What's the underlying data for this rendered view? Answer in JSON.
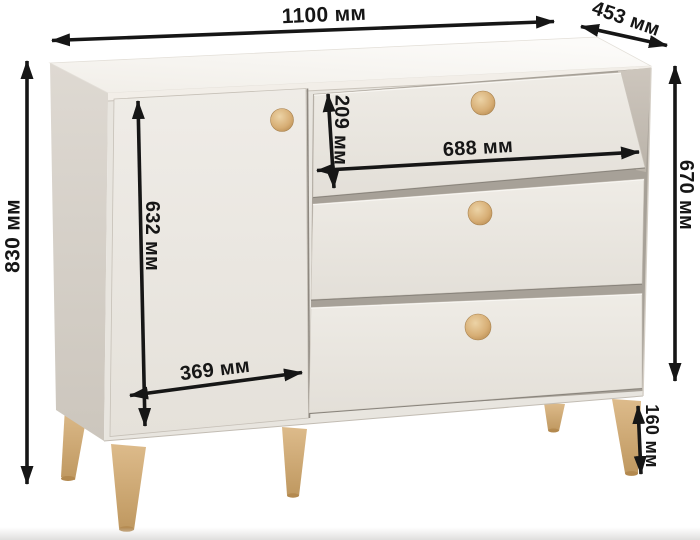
{
  "diagram": {
    "type": "furniture-dimension-diagram",
    "subject": "chest-of-drawers-with-door",
    "unit": "мм"
  },
  "labels": {
    "overall_width": "1100 мм",
    "depth": "453 мм",
    "overall_height": "830 мм",
    "door_height": "632 мм",
    "top_drawer_height": "209 мм",
    "drawers_width": "688 мм",
    "carcass_height": "670 мм",
    "door_width": "369 мм",
    "leg_height": "160 мм"
  },
  "colors": {
    "background": "#ffffff",
    "arrow": "#161616",
    "body_front": "#e8e5df",
    "body_top": "#f5f2ec",
    "side_panel": "#d6d0c8",
    "gap_shadow": "#a7a198",
    "leg_wood": "#d2aa74",
    "knob_wood": "#d8b37c"
  }
}
